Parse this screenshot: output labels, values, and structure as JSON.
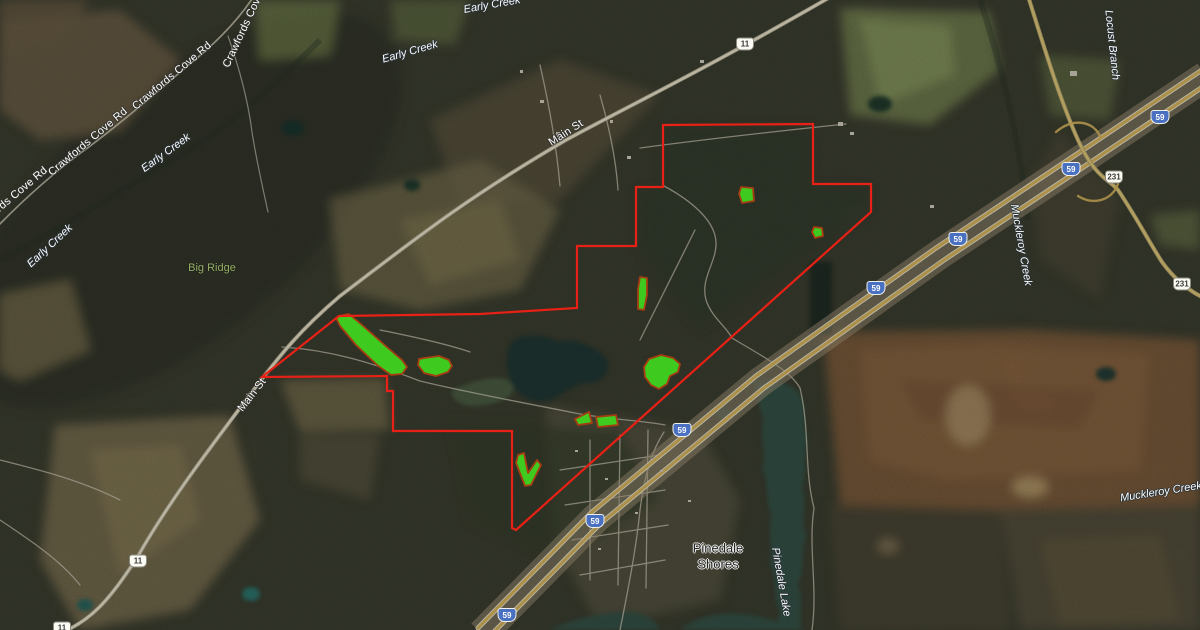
{
  "map": {
    "labels": {
      "roads": [
        {
          "text": "Crawfords Cove Rd",
          "x": 247,
          "y": 22,
          "r": -65
        },
        {
          "text": "Crawfords Cove Rd",
          "x": 172,
          "y": 76,
          "r": -40
        },
        {
          "text": "Crawfords Cove Rd",
          "x": 88,
          "y": 142,
          "r": -40
        },
        {
          "text": "Crawfords Cove Rd",
          "x": 8,
          "y": 201,
          "r": -40
        },
        {
          "text": "Main St",
          "x": 566,
          "y": 133,
          "r": -33
        },
        {
          "text": "Main St",
          "x": 252,
          "y": 395,
          "r": -52
        }
      ],
      "water": [
        {
          "text": "Early Creek",
          "x": 50,
          "y": 246,
          "r": -43
        },
        {
          "text": "Early Creek",
          "x": 166,
          "y": 153,
          "r": -36
        },
        {
          "text": "Early Creek",
          "x": 410,
          "y": 52,
          "r": -16
        },
        {
          "text": "Early Creek",
          "x": 492,
          "y": 5,
          "r": -10
        },
        {
          "text": "Locust Branch",
          "x": 1112,
          "y": 45,
          "r": 84
        },
        {
          "text": "Muckleroy Creek",
          "x": 1021,
          "y": 245,
          "r": 80
        },
        {
          "text": "Muckleroy Creek",
          "x": 1161,
          "y": 492,
          "r": -9
        },
        {
          "text": "Pinedale Lake",
          "x": 781,
          "y": 582,
          "r": 80
        }
      ],
      "places": [
        {
          "text": "Pinedale Shores",
          "x": 718,
          "y": 556,
          "r": 0
        }
      ],
      "terrain": [
        {
          "text": "Big Ridge",
          "x": 212,
          "y": 268,
          "r": 0
        }
      ]
    },
    "shields": {
      "interstate": [
        {
          "n": "59",
          "x": 1160,
          "y": 117
        },
        {
          "n": "59",
          "x": 1071,
          "y": 169
        },
        {
          "n": "59",
          "x": 958,
          "y": 239
        },
        {
          "n": "59",
          "x": 876,
          "y": 288
        },
        {
          "n": "59",
          "x": 682,
          "y": 430
        },
        {
          "n": "59",
          "x": 595,
          "y": 521
        },
        {
          "n": "59",
          "x": 507,
          "y": 615
        }
      ],
      "us_routes": [
        {
          "n": "11",
          "x": 745,
          "y": 44
        },
        {
          "n": "11",
          "x": 138,
          "y": 561
        },
        {
          "n": "11",
          "x": 62,
          "y": 628
        },
        {
          "n": "231",
          "x": 1114,
          "y": 177
        },
        {
          "n": "231",
          "x": 1182,
          "y": 284
        }
      ]
    },
    "colors": {
      "boundary": "#e82015",
      "plot_fill": "#3fd31f",
      "plot_stroke": "#a63c12",
      "interstate_shield": "#4a70c2"
    }
  },
  "overlays": {
    "property_boundary_points": "339,316 480,314 577,308 577,246 636,246 636,187 663,187 663,125 813,124 813,184 871,184 871,212 516,530 512,528 512,431 393,431 393,391 387,391 387,376 262,377",
    "plots": [
      "339,316 349,314 362,325 388,348 402,360 407,367 402,374 391,375 377,365 356,345 340,326 336,318",
      "424,358 439,356 449,360 452,366 448,372 436,376 424,373 418,365 419,359",
      "741,187 753,188 754,201 742,203 739,194",
      "814,227 822,228 823,236 815,238 812,232",
      "640,277 647,278 647,295 644,310 638,309 638,289",
      "649,359 661,355 673,358 680,364 678,372 670,376 667,384 659,389 651,385 645,377 644,367",
      "575,419 589,412 592,423 578,425",
      "596,417 616,415 618,425 598,427",
      "518,455 524,453 528,473 537,460 541,465 531,485 525,486 516,463"
    ]
  }
}
